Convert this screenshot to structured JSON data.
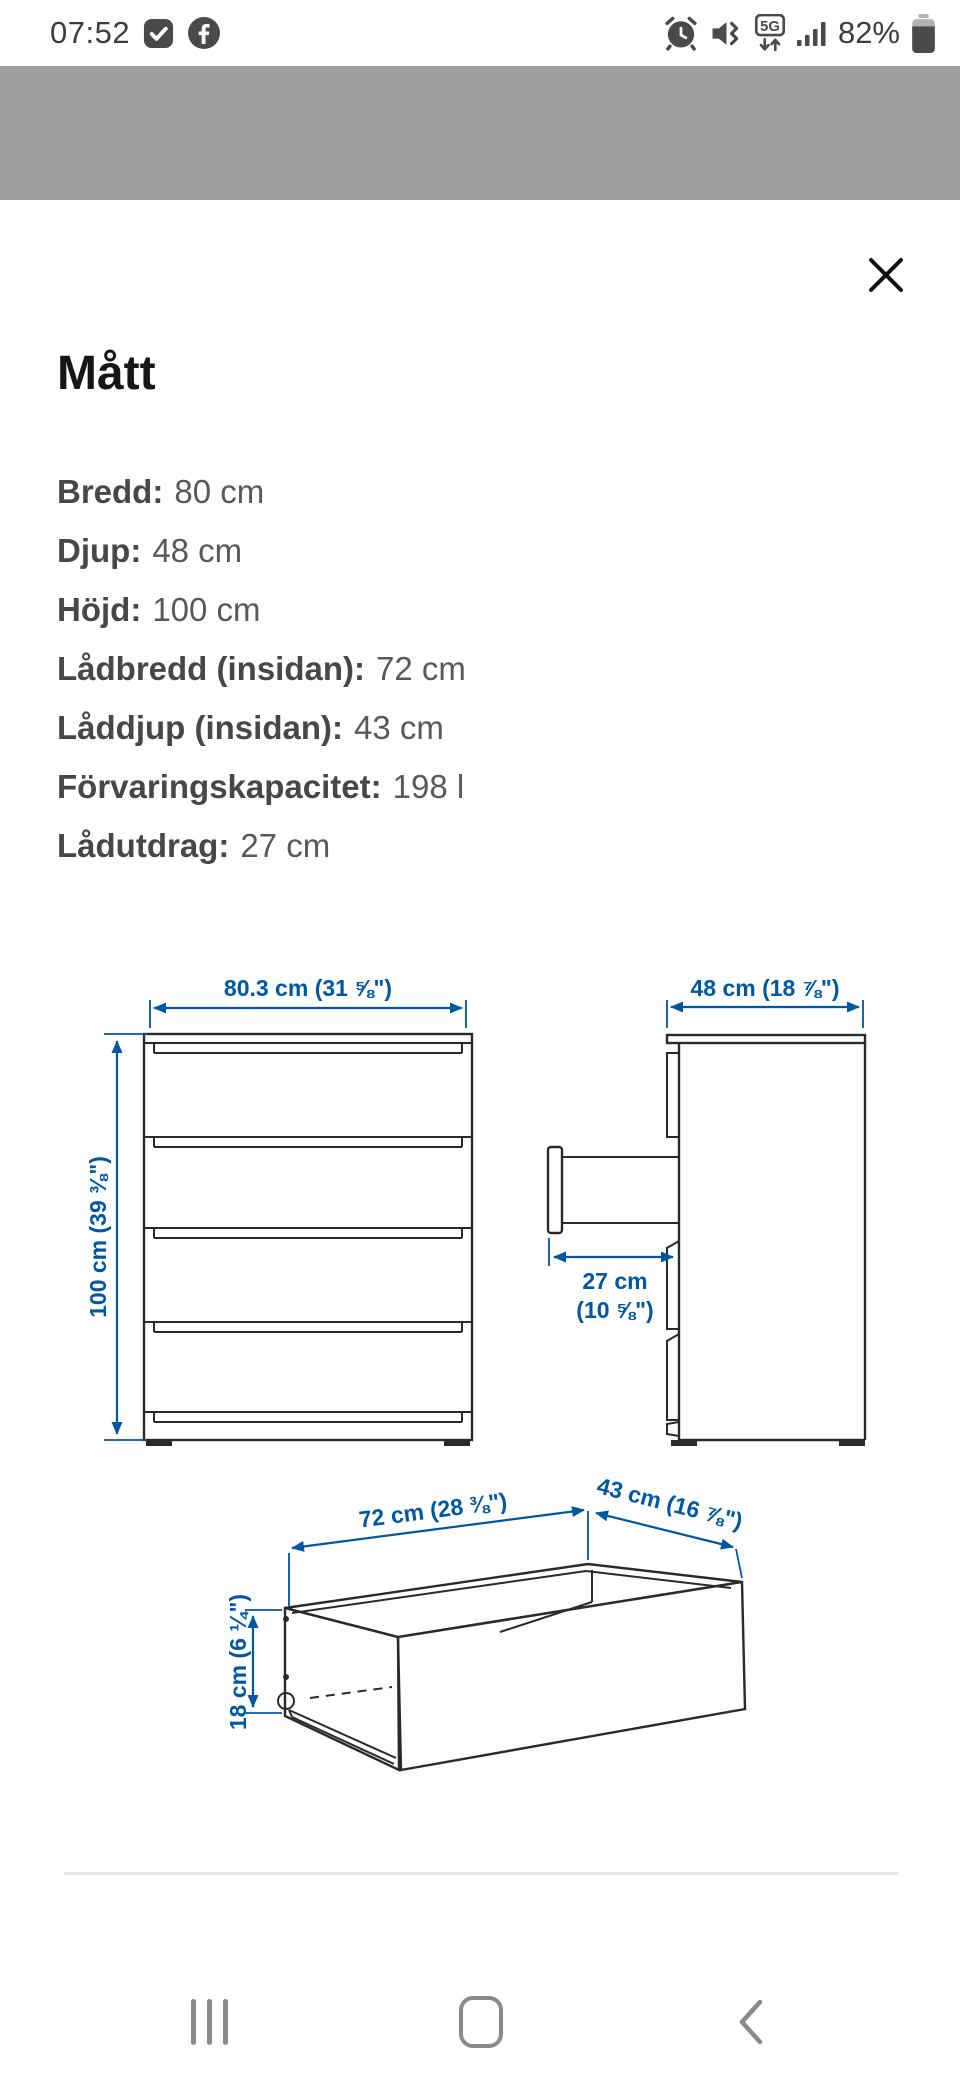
{
  "status_bar": {
    "time": "07:52",
    "battery_percent": "82%",
    "network_label": "5G"
  },
  "sheet": {
    "title": "Mått",
    "specs": [
      {
        "label": "Bredd:",
        "value": "80 cm"
      },
      {
        "label": "Djup:",
        "value": "48 cm"
      },
      {
        "label": "Höjd:",
        "value": "100 cm"
      },
      {
        "label": "Lådbredd (insidan):",
        "value": "72 cm"
      },
      {
        "label": "Låddjup (insidan):",
        "value": "43 cm"
      },
      {
        "label": "Förvaringskapacitet:",
        "value": "198 l"
      },
      {
        "label": "Lådutdrag:",
        "value": "27 cm"
      }
    ],
    "diagram": {
      "front_width_label": "80.3 cm (31 ⅝\")",
      "side_depth_label": "48 cm (18 ⅞\")",
      "height_label": "100 cm (39 ⅜\")",
      "extension_label_line1": "27 cm",
      "extension_label_line2": "(10 ⅝\")",
      "drawer_width_label": "72 cm (28 ⅜\")",
      "drawer_depth_label": "43 cm (16 ⅞\")",
      "drawer_height_label": "18 cm (6 ¼\")"
    },
    "colors": {
      "dimension_blue": "#0058a3",
      "outline_dark": "#2a2a2a",
      "backdrop_gray": "#9e9e9e"
    }
  }
}
